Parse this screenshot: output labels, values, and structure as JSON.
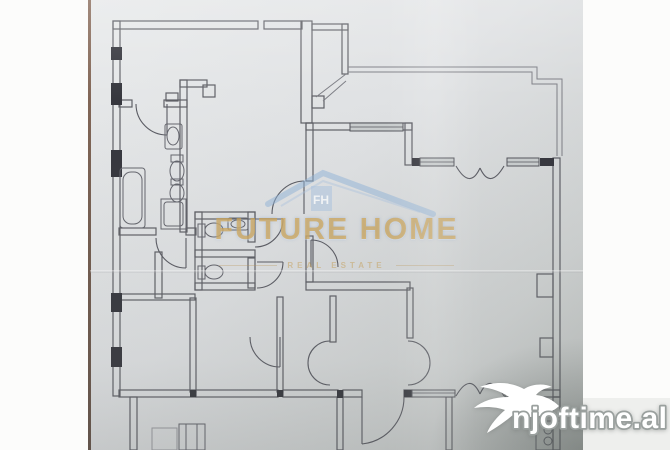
{
  "document": {
    "type": "apartment-floor-plan-photo",
    "paper_color": "#dfe1e3",
    "line_color": "#54555c"
  },
  "watermark": {
    "title": "FUTURE HOME",
    "subtitle": "Real Estate",
    "monogram": "FH",
    "title_color": "#d6a03a",
    "roof_color": "#8fb3da"
  },
  "brand_badge": {
    "label": "njoftime.al",
    "icon": "swallow-bird-icon",
    "text_color": "#ffffff",
    "outline_color": "#9aa09e"
  }
}
